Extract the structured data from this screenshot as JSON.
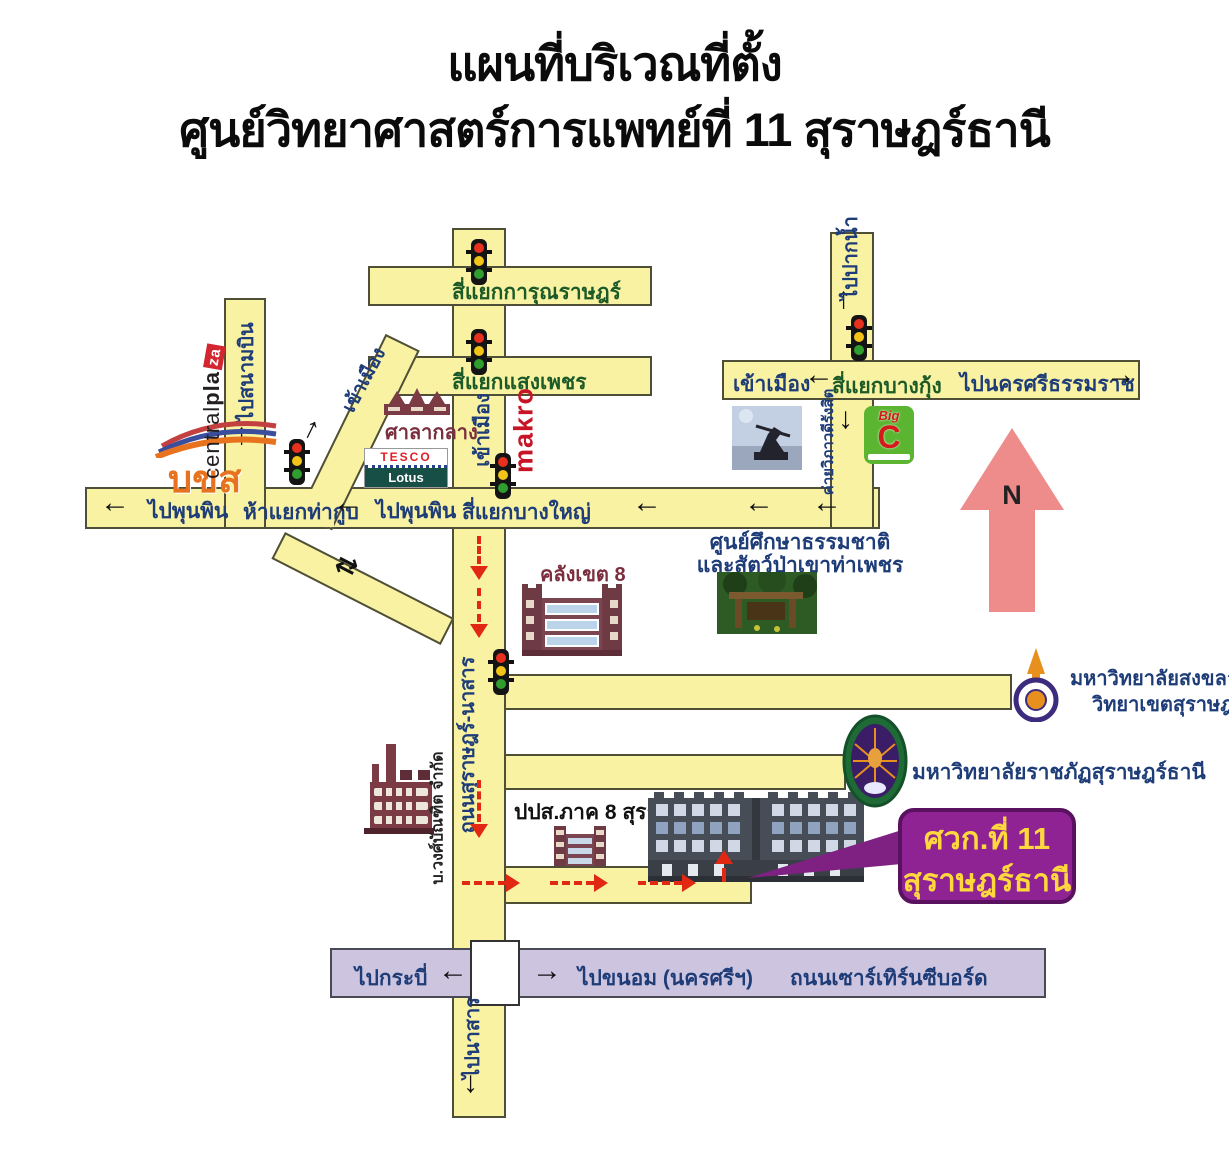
{
  "title": {
    "line1": "แผนที่บริเวณที่ตั้ง",
    "line2": "ศูนย์วิทยาศาสตร์การแพทย์ที่ 11 สุราษฎร์ธานี"
  },
  "icons": {
    "left": "←",
    "right": "→",
    "up": "↑",
    "down": "↓",
    "twoway": "⇄",
    "north": "N"
  },
  "roads": {
    "karun": "สี่แยกการุณราษฎร์",
    "saengphet": "สี่แยกแสงเพชร",
    "bangyai": "สี่แยกบางใหญ่",
    "thakup": "ห้าแยกท่ากูบ",
    "bangkung": "สี่แยกบางกุ้ง",
    "phunphin_far": "ไปพุนพิน",
    "phunphin_near": "ไปพุนพิน",
    "airport": "ไปสนามบิน",
    "town_diag": "เข้าเมือง",
    "town_main": "เข้าเมือง",
    "town_right": "เข้าเมือง",
    "paknam": "ไปปากน้ำ",
    "nakhonsi": "ไปนครศรีธรรมราช",
    "surat_nasan": "ถนนสุราษฎร์-นาสาร",
    "krabi": "ไปกระบี่",
    "khanom": "ไปขนอม (นครศรีฯ)",
    "seaboard": "ถนนเซาร์เทิร์นซีบอร์ด",
    "nasan": "ไปนาสาร"
  },
  "places": {
    "bus_terminal": "บขส",
    "centralplaza_a": "central",
    "centralplaza_b": "pla",
    "centralplaza_c": "za",
    "city_hall": "ศาลากลาง",
    "tesco": "TESCO",
    "lotus": "Lotus",
    "makro": "makro",
    "bigc_big": "Big",
    "bigc_c": "C",
    "camp": "ค่ายวิภาวดีรังสิต",
    "nature1": "ศูนย์ศึกษาธรรมชาติ",
    "nature2": "และสัตว์ป่าเขาท่าเพชร",
    "treasury": "คลังเขต 8",
    "psu1": "มหาวิทยาลัยสงขลานครินทร์",
    "psu2": "วิทยาเขตสุราษฎร์ธานี",
    "rajabhat": "มหาวิทยาลัยราชภัฏสุราษฎร์ธานี",
    "wongbandit": "บ.วงศ์บัณฑิต จำกัด",
    "oncb": "ปปส.ภาค 8 สุราษฎร์ธานี"
  },
  "callout": {
    "line1": "ศวก.ที่ 11",
    "line2": "สุราษฎร์ธานี"
  },
  "colors": {
    "road_yellow": "#F8F2A2",
    "road_outline": "#4F4F38",
    "seaboard_lavender": "#CDC5DF",
    "route_red": "#E02813",
    "callout_purple": "#8F2394",
    "callout_text": "#FFD83D",
    "label_navy": "#1E3C78",
    "label_green": "#1C5A28",
    "building_maroon": "#7A2E3E",
    "north_pink": "#EE8B8B",
    "makro_red": "#C81427",
    "bigc_green": "#5BB531",
    "lotus_green": "#174F46",
    "tesco_red": "#E21E26",
    "bks_orange": "#E8731E"
  }
}
